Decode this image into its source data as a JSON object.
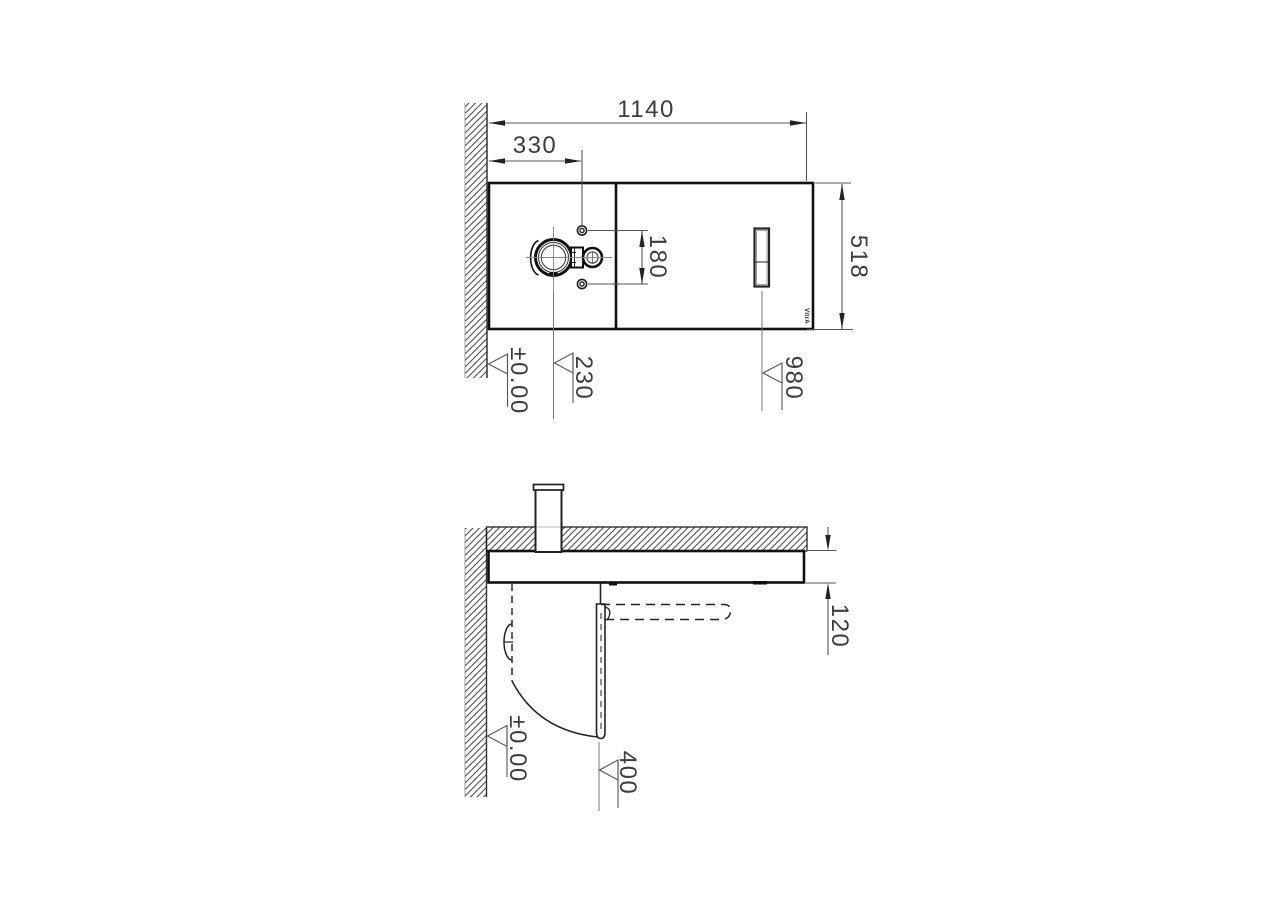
{
  "brand": "VitrA",
  "top_view": {
    "dim_width": "1140",
    "dim_offset": "330",
    "dim_height": "518",
    "dim_bolt_spacing": "180",
    "level_datum": "±0.00",
    "level_spout": "230",
    "level_panel": "980"
  },
  "side_view": {
    "dim_thickness": "120",
    "level_datum": "±0.00",
    "level_reach": "400"
  },
  "colors": {
    "outline": "#1a1a1a",
    "dimension": "#555555",
    "hatch": "#4a4a4a",
    "background": "#ffffff"
  }
}
